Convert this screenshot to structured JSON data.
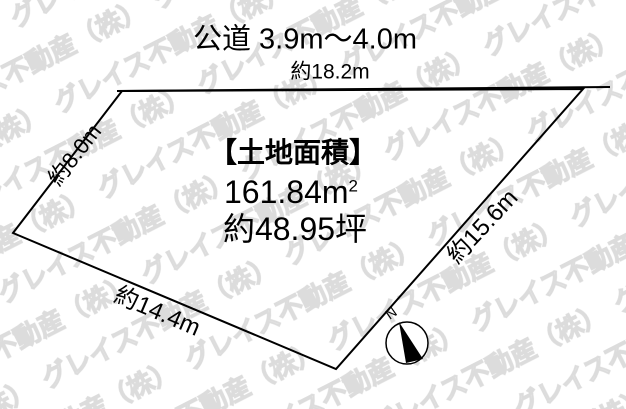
{
  "diagram": {
    "road_label": "公道 3.9m〜4.0m",
    "edges": {
      "top": "約18.2m",
      "left": "約8.0m",
      "right": "約15.6m",
      "bottom": "約14.4m"
    },
    "area": {
      "title": "【土地面積】",
      "sqm_value": "161.84m",
      "sqm_sup": "2",
      "tsubo": "約48.95坪"
    },
    "compass": {
      "north_label": "N"
    },
    "watermark": {
      "text": "グレイス不動産（株）"
    },
    "colors": {
      "line": "#000000",
      "watermark_outline": "#dcdcdc",
      "background": "#ffffff"
    }
  }
}
